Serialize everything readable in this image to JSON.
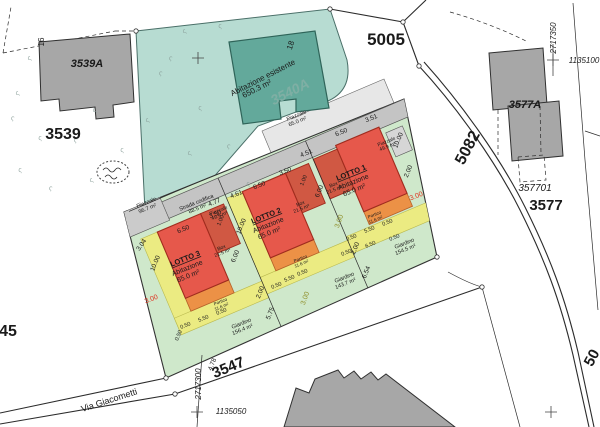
{
  "plan": {
    "colors": {
      "teal": "#b7dcd2",
      "teal-bldg": "#63a99b",
      "gray-bldg": "#a7a7a7",
      "band": "#c4c4c4",
      "parcel-green": "#cfe8cb",
      "house-red": "#e6584b",
      "box-red": "#d05843",
      "portico-orange": "#ec9146",
      "strip-yellow": "#ebeb82",
      "line": "#2b2b2b",
      "red-dim": "#e03020",
      "olive-dim": "#8f8f2a"
    },
    "region_labels": [
      {
        "n": "parcel-5005",
        "t": "5005",
        "x": 386,
        "y": 45,
        "s": 17,
        "w": 700
      },
      {
        "n": "parcel-3539",
        "t": "3539",
        "x": 63,
        "y": 139,
        "s": 16,
        "w": 700
      },
      {
        "n": "building-3539a-label",
        "t": "3539A",
        "x": 87,
        "y": 67,
        "s": 11,
        "w": 700,
        "i": 1
      },
      {
        "n": "parcel-45",
        "t": "45",
        "x": 8,
        "y": 336,
        "s": 16,
        "w": 700
      },
      {
        "n": "road-3547",
        "t": "3547",
        "x": 230,
        "y": 372,
        "s": 15,
        "w": 700,
        "r": -22
      },
      {
        "n": "road-via-giacometti",
        "t": "Via Giacometti",
        "x": 110,
        "y": 403,
        "s": 9,
        "r": -18
      },
      {
        "n": "road-5082",
        "t": "5082",
        "x": 472,
        "y": 150,
        "s": 16,
        "w": 700,
        "r": -62
      },
      {
        "n": "road-50-partial",
        "t": "50",
        "x": 596,
        "y": 360,
        "s": 15,
        "w": 700,
        "r": -62
      },
      {
        "n": "parcel-3577",
        "t": "3577",
        "x": 546,
        "y": 210,
        "s": 15,
        "w": 700
      },
      {
        "n": "building-3577a-label",
        "t": "3577A",
        "x": 525,
        "y": 108,
        "s": 11,
        "w": 700,
        "i": 1
      },
      {
        "n": "parcel-357701",
        "t": "357701",
        "x": 535,
        "y": 191,
        "s": 10,
        "i": 1
      },
      {
        "n": "coord-2717350",
        "t": "2717350",
        "x": 556,
        "y": 38,
        "s": 8,
        "i": 1,
        "r": -90
      },
      {
        "n": "coord-1135100",
        "t": "1135100",
        "x": 584,
        "y": 63,
        "s": 8,
        "i": 1
      },
      {
        "n": "coord-2717300",
        "t": "2717300",
        "x": 201,
        "y": 384,
        "s": 8,
        "i": 1,
        "r": -90
      },
      {
        "n": "coord-1135050",
        "t": "1135050",
        "x": 231,
        "y": 414,
        "s": 8,
        "i": 1
      },
      {
        "n": "house-number-16",
        "t": "16",
        "x": 44,
        "y": 42,
        "s": 8,
        "r": -90
      },
      {
        "n": "house-number-18",
        "t": "18",
        "x": 293,
        "y": 46,
        "s": 8,
        "r": -72
      },
      {
        "n": "existing-house-label",
        "t": "Abitazione esistente",
        "x": 264,
        "y": 80,
        "s": 8,
        "r": -27
      },
      {
        "n": "existing-house-area",
        "t": "650.3 m²",
        "x": 258,
        "y": 91,
        "s": 8,
        "r": -27
      },
      {
        "n": "existing-house-ghost",
        "t": "3540A",
        "x": 292,
        "y": 96,
        "s": 14,
        "i": 1,
        "w": 700,
        "c": "#7fafa4",
        "r": -27
      },
      {
        "n": "piazzale-967",
        "t": "Piazzale",
        "x": 147,
        "y": 204,
        "s": 5.5,
        "r": -22
      },
      {
        "n": "piazzale-967-area",
        "t": "96.7 m²",
        "x": 148,
        "y": 210,
        "s": 5.5,
        "r": -22
      },
      {
        "n": "strada-codifica",
        "t": "Strada codifica",
        "x": 197,
        "y": 204,
        "s": 5.5,
        "r": -22
      },
      {
        "n": "strada-codifica-area",
        "t": "88.5 m²",
        "x": 198,
        "y": 210,
        "s": 5.5,
        "r": -22
      },
      {
        "n": "piazzale-495",
        "t": "Piazzale",
        "x": 219,
        "y": 212,
        "s": 5,
        "r": -22
      },
      {
        "n": "piazzale-495-area",
        "t": "49.5 m²",
        "x": 220,
        "y": 217,
        "s": 5,
        "r": -22
      },
      {
        "n": "piazzale-650",
        "t": "Piazzale",
        "x": 297,
        "y": 117,
        "s": 5.5,
        "r": -22
      },
      {
        "n": "piazzale-650-area",
        "t": "65.0 m²",
        "x": 298,
        "y": 123,
        "s": 5.5,
        "r": -22
      },
      {
        "n": "piazzale-499",
        "t": "Piazzale",
        "x": 387,
        "y": 143,
        "s": 5,
        "r": -22
      },
      {
        "n": "piazzale-499-area",
        "t": "49.9 m²",
        "x": 388,
        "y": 148,
        "s": 5,
        "r": -22
      },
      {
        "n": "lotto3-title",
        "t": "LOTTO 3",
        "x": 186,
        "y": 261,
        "s": 7.5,
        "w": 700,
        "r": -22,
        "u": 1
      },
      {
        "n": "lotto3-type",
        "t": "Abitazione",
        "x": 188,
        "y": 270,
        "s": 7,
        "r": -22
      },
      {
        "n": "lotto3-area",
        "t": "65.0 m²",
        "x": 189,
        "y": 278,
        "s": 7,
        "r": -22
      },
      {
        "n": "lotto2-title",
        "t": "LOTTO 2",
        "x": 267,
        "y": 218,
        "s": 7.5,
        "w": 700,
        "r": -22,
        "u": 1
      },
      {
        "n": "lotto2-type",
        "t": "Abitazione",
        "x": 269,
        "y": 227,
        "s": 7,
        "r": -22
      },
      {
        "n": "lotto2-area",
        "t": "65.0 m²",
        "x": 270,
        "y": 235,
        "s": 7,
        "r": -22
      },
      {
        "n": "lotto1-title",
        "t": "LOTTO 1",
        "x": 352,
        "y": 175,
        "s": 7.5,
        "w": 700,
        "r": -22,
        "u": 1
      },
      {
        "n": "lotto1-type",
        "t": "Abitazione",
        "x": 354,
        "y": 184,
        "s": 7,
        "r": -22
      },
      {
        "n": "lotto1-area",
        "t": "65.0 m²",
        "x": 355,
        "y": 192,
        "s": 7,
        "r": -22
      },
      {
        "n": "box3-label",
        "t": "Box",
        "x": 222,
        "y": 249,
        "s": 5,
        "r": -22
      },
      {
        "n": "box3-area",
        "t": "21.5 m²",
        "x": 223,
        "y": 254,
        "s": 5,
        "r": -22
      },
      {
        "n": "box2-label",
        "t": "Box",
        "x": 301,
        "y": 205,
        "s": 5,
        "r": -22
      },
      {
        "n": "box2-area",
        "t": "21.5 m²",
        "x": 302,
        "y": 210,
        "s": 5,
        "r": -22
      },
      {
        "n": "box1-label",
        "t": "Box",
        "x": 334,
        "y": 186,
        "s": 5,
        "r": -22
      },
      {
        "n": "box1-area",
        "t": "21.5 m²",
        "x": 335,
        "y": 191,
        "s": 5,
        "r": -22
      },
      {
        "n": "portico3-label",
        "t": "Portico",
        "x": 221,
        "y": 303,
        "s": 4.5,
        "r": -22
      },
      {
        "n": "portico3-area",
        "t": "11.6 m²",
        "x": 222,
        "y": 308,
        "s": 4.5,
        "r": -22
      },
      {
        "n": "portico2-label",
        "t": "Portico",
        "x": 301,
        "y": 260,
        "s": 4.5,
        "r": -22
      },
      {
        "n": "portico2-area",
        "t": "11.6 m²",
        "x": 302,
        "y": 265,
        "s": 4.5,
        "r": -22
      },
      {
        "n": "portico1-label",
        "t": "Portico",
        "x": 375,
        "y": 216,
        "s": 4.5,
        "r": -22
      },
      {
        "n": "portico1-area",
        "t": "11.6 m²",
        "x": 376,
        "y": 221,
        "s": 4.5,
        "r": -22
      },
      {
        "n": "giardino3-label",
        "t": "Giardino",
        "x": 242,
        "y": 325,
        "s": 5.5,
        "r": -22
      },
      {
        "n": "giardino3-area",
        "t": "156.4 m²",
        "x": 243,
        "y": 331,
        "s": 5.5,
        "r": -22
      },
      {
        "n": "giardino2-label",
        "t": "Giardino",
        "x": 345,
        "y": 279,
        "s": 5.5,
        "r": -22
      },
      {
        "n": "giardino2-area",
        "t": "143.7 m²",
        "x": 346,
        "y": 285,
        "s": 5.5,
        "r": -22
      },
      {
        "n": "giardino1-label",
        "t": "Giardino",
        "x": 405,
        "y": 245,
        "s": 5.5,
        "r": -22
      },
      {
        "n": "giardino1-area",
        "t": "154.5 m²",
        "x": 406,
        "y": 251,
        "s": 5.5,
        "r": -22
      },
      {
        "n": "setback-red",
        "t": "3.00",
        "x": 152,
        "y": 301,
        "s": 7,
        "c": "#e03020",
        "r": -22
      },
      {
        "n": "setback-red",
        "t": "3.00",
        "x": 417,
        "y": 198,
        "s": 7,
        "c": "#e03020",
        "r": -22
      },
      {
        "n": "setback-olive",
        "t": "3.00",
        "x": 307,
        "y": 299,
        "s": 7,
        "c": "#8f8f2a",
        "r": -70
      },
      {
        "n": "setback-olive",
        "t": "3.00",
        "x": 341,
        "y": 222,
        "s": 7,
        "c": "#8f8f2a",
        "r": -70
      },
      {
        "n": "dim-label",
        "t": "3.04",
        "x": 143,
        "y": 246,
        "r": -55
      },
      {
        "n": "dim-label",
        "t": "6.50",
        "x": 184,
        "y": 231,
        "r": -22
      },
      {
        "n": "dim-label",
        "t": "3.50",
        "x": 216,
        "y": 216,
        "r": -22
      },
      {
        "n": "dim-label",
        "t": "4.61",
        "x": 237,
        "y": 196,
        "r": -22
      },
      {
        "n": "dim-label",
        "t": "6.50",
        "x": 260,
        "y": 187,
        "r": -22
      },
      {
        "n": "dim-label",
        "t": "3.50",
        "x": 286,
        "y": 173,
        "r": -22
      },
      {
        "n": "dim-label",
        "t": "4.77",
        "x": 215,
        "y": 204,
        "r": -22
      },
      {
        "n": "dim-label",
        "t": "4.51",
        "x": 307,
        "y": 155,
        "r": -22
      },
      {
        "n": "dim-label",
        "t": "6.50",
        "x": 342,
        "y": 134,
        "r": -22
      },
      {
        "n": "dim-label",
        "t": "3.51",
        "x": 372,
        "y": 120,
        "r": -22
      },
      {
        "n": "dim-label",
        "t": "10.00",
        "x": 157,
        "y": 264,
        "r": -68
      },
      {
        "n": "dim-label",
        "t": "10.00",
        "x": 243,
        "y": 227,
        "r": -68
      },
      {
        "n": "dim-label",
        "t": "10.00",
        "x": 400,
        "y": 141,
        "r": -68
      },
      {
        "n": "dim-label",
        "t": "2.00",
        "x": 410,
        "y": 172,
        "r": -68
      },
      {
        "n": "dim-label",
        "t": "1.00",
        "x": 222,
        "y": 221,
        "s": 5.5,
        "r": -68
      },
      {
        "n": "dim-label",
        "t": "6.00",
        "x": 237,
        "y": 257,
        "r": -68
      },
      {
        "n": "dim-label",
        "t": "1.00",
        "x": 305,
        "y": 181,
        "s": 5.5,
        "r": -68
      },
      {
        "n": "dim-label",
        "t": "6.00",
        "x": 321,
        "y": 192,
        "r": -68
      },
      {
        "n": "dim-label",
        "t": "0.50",
        "x": 186,
        "y": 327,
        "s": 5.5,
        "r": -22
      },
      {
        "n": "dim-label",
        "t": "5.50",
        "x": 204,
        "y": 320,
        "s": 5.5,
        "r": -22
      },
      {
        "n": "dim-label",
        "t": "0.50",
        "x": 222,
        "y": 313,
        "s": 5.5,
        "r": -22
      },
      {
        "n": "dim-label",
        "t": "0.50",
        "x": 277,
        "y": 287,
        "s": 5.5,
        "r": -22
      },
      {
        "n": "dim-label",
        "t": "5.50",
        "x": 290,
        "y": 280,
        "s": 5.5,
        "r": -22
      },
      {
        "n": "dim-label",
        "t": "0.50",
        "x": 303,
        "y": 274,
        "s": 5.5,
        "r": -22
      },
      {
        "n": "dim-label",
        "t": "0.50",
        "x": 352,
        "y": 239,
        "s": 5.5,
        "r": -22
      },
      {
        "n": "dim-label",
        "t": "5.50",
        "x": 370,
        "y": 231,
        "s": 5.5,
        "r": -22
      },
      {
        "n": "dim-label",
        "t": "0.50",
        "x": 388,
        "y": 224,
        "s": 5.5,
        "r": -22
      },
      {
        "n": "dim-label",
        "t": "0.50",
        "x": 347,
        "y": 254,
        "s": 5.5,
        "r": -22
      },
      {
        "n": "dim-label",
        "t": "6.50",
        "x": 371,
        "y": 246,
        "s": 5.5,
        "r": -22
      },
      {
        "n": "dim-label",
        "t": "0.50",
        "x": 395,
        "y": 239,
        "s": 5.5,
        "r": -22
      },
      {
        "n": "dim-label",
        "t": "0.50",
        "x": 180,
        "y": 336,
        "s": 5.5,
        "r": -68
      },
      {
        "n": "dim-label",
        "t": "2.00",
        "x": 262,
        "y": 293,
        "r": -68
      },
      {
        "n": "dim-label",
        "t": "5.75",
        "x": 272,
        "y": 314,
        "r": -68
      },
      {
        "n": "dim-label",
        "t": "2.00",
        "x": 357,
        "y": 249,
        "r": -68
      },
      {
        "n": "dim-label",
        "t": "6.54",
        "x": 368,
        "y": 273,
        "r": -68
      },
      {
        "n": "dim-label",
        "t": "4.78",
        "x": 214,
        "y": 365,
        "r": -68
      }
    ],
    "grass_marks": [
      [
        185,
        33
      ],
      [
        220,
        28
      ],
      [
        160,
        75
      ],
      [
        148,
        122
      ],
      [
        200,
        110
      ],
      [
        228,
        148
      ],
      [
        190,
        155
      ],
      [
        248,
        186
      ],
      [
        170,
        60
      ],
      [
        18,
        95
      ],
      [
        40,
        140
      ],
      [
        75,
        142
      ],
      [
        95,
        112
      ],
      [
        20,
        172
      ],
      [
        50,
        190
      ],
      [
        92,
        182
      ],
      [
        122,
        152
      ],
      [
        12,
        120
      ],
      [
        30,
        60
      ]
    ],
    "vertex_nodes": [
      [
        136,
        31
      ],
      [
        330,
        9
      ],
      [
        403,
        22
      ],
      [
        419,
        66
      ],
      [
        175,
        394
      ],
      [
        166,
        378
      ],
      [
        437,
        257
      ],
      [
        482,
        287
      ]
    ],
    "survey_crosses": [
      [
        198,
        58
      ],
      [
        553,
        60
      ],
      [
        197,
        412
      ],
      [
        551,
        412
      ]
    ]
  }
}
